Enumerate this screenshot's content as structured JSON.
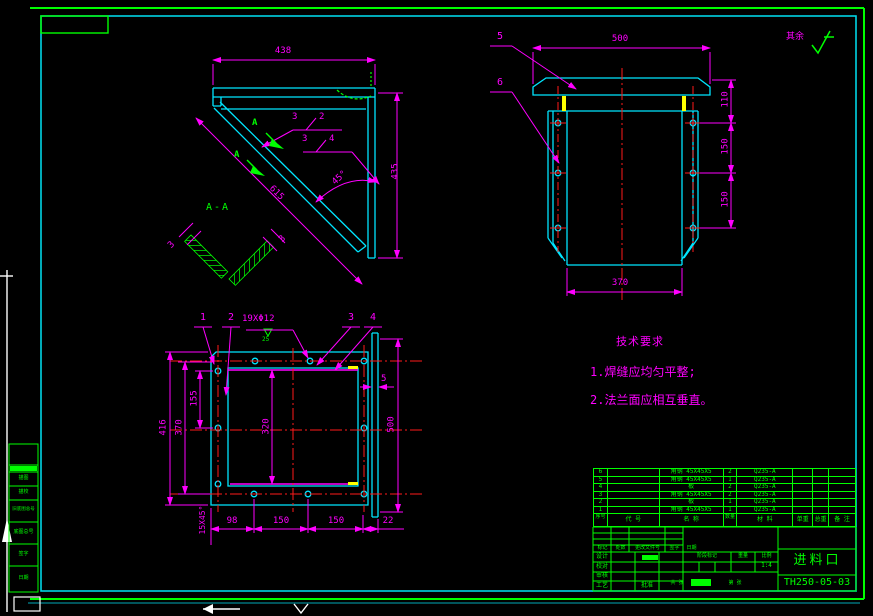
{
  "colors": {
    "frame_green": "#00ff00",
    "line_cyan": "#00e5ff",
    "dimension_magenta": "#ff00ff",
    "centerline_red": "#ff1a1a",
    "highlight_yellow": "#ffff00"
  },
  "finish": {
    "label": "其余"
  },
  "v1": {
    "d438": "438",
    "d435": "435",
    "d615": "615",
    "angle": "45°",
    "section_label": "A-A",
    "arrow1": "A",
    "arrow2": "A",
    "weld1_left": "3",
    "weld1_right": "2",
    "weld2_left": "3",
    "weld2_right": "4",
    "thk_left": "3",
    "thk_right": "3"
  },
  "v2": {
    "c5": "5",
    "c6": "6",
    "d500": "500",
    "d110": "110",
    "d150a": "150",
    "d150b": "150",
    "d370": "370"
  },
  "v3": {
    "c1": "1",
    "c2": "2",
    "c3": "3",
    "c4": "4",
    "hole_note": "19XΦ12",
    "weld_size": "25",
    "d416": "416",
    "d370": "370",
    "d155": "155",
    "d320": "320",
    "d500": "500",
    "d5": "5",
    "b98": "98",
    "b150a": "150",
    "b150b": "150",
    "b22": "22",
    "chamfer": "15X45°"
  },
  "notes": {
    "title": "技术要求",
    "item1": "1.焊缝应均匀平整;",
    "item2": "2.法兰面应相互垂直。"
  },
  "bom": {
    "h": {
      "no": "序号",
      "code": "代  号",
      "name": "名  称",
      "qty": "数量",
      "mat": "材  料",
      "unit": "单重",
      "total": "总重",
      "rem": "备 注"
    },
    "rows": [
      {
        "no": "6",
        "code": "",
        "name": "角钢 45X45X5",
        "qty": "2",
        "mat": "Q235-A"
      },
      {
        "no": "5",
        "code": "",
        "name": "角钢 45X45X5",
        "qty": "1",
        "mat": "Q235-A"
      },
      {
        "no": "4",
        "code": "",
        "name": "板",
        "qty": "2",
        "mat": "Q235-A"
      },
      {
        "no": "3",
        "code": "",
        "name": "角钢 45X45X5",
        "qty": "2",
        "mat": "Q235-A"
      },
      {
        "no": "2",
        "code": "",
        "name": "板",
        "qty": "1",
        "mat": "Q235-A"
      },
      {
        "no": "1",
        "code": "",
        "name": "角钢 45X45X5",
        "qty": "1",
        "mat": "Q235-A"
      }
    ]
  },
  "tb": {
    "part_name": "进料口",
    "drawing_no": "TH250-05-03",
    "mark": "标记",
    "count": "处数",
    "doc": "更改文件号",
    "sign": "签字",
    "date": "日期",
    "design": "设计",
    "check": "校对",
    "review": "审核",
    "process": "工艺",
    "approve": "批准",
    "stage": "阶段标记",
    "weight": "重量",
    "scale_label": "比例",
    "scale": "1:4",
    "sheets": "共 张",
    "sheet_no": "第 张"
  },
  "margin": {
    "r1": "描图",
    "r2": "描校",
    "r3": "旧底图总号",
    "r4": "底图总号",
    "r5": "签字",
    "r6": "日期"
  }
}
